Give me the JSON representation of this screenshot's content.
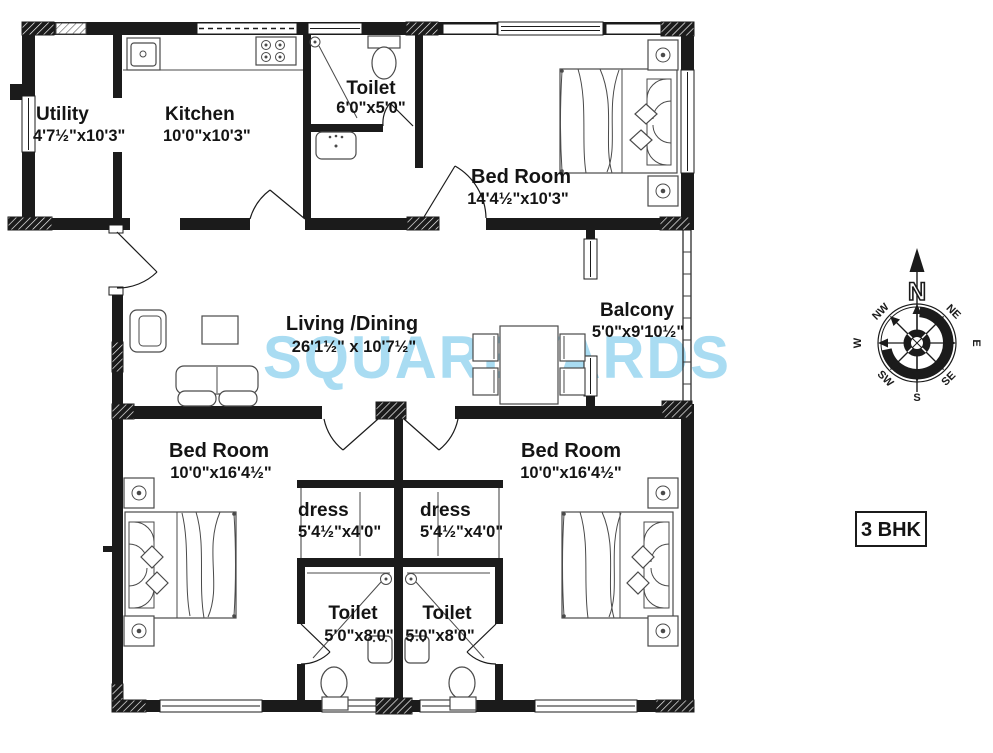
{
  "watermark": "SQUAREYARDS",
  "unit_label": "3 BHK",
  "rooms": {
    "utility": {
      "name": "Utility",
      "dims": "4'7½\"x10'3\""
    },
    "kitchen": {
      "name": "Kitchen",
      "dims": "10'0\"x10'3\""
    },
    "toilet_top": {
      "name": "Toilet",
      "dims": "6'0\"x5'0\""
    },
    "bedroom_top": {
      "name": "Bed Room",
      "dims": "14'4½\"x10'3\""
    },
    "living_dining": {
      "name": "Living /Dining",
      "dims": "26'1½\" x 10'7½\""
    },
    "balcony": {
      "name": "Balcony",
      "dims": "5'0\"x9'10½\""
    },
    "bedroom_left": {
      "name": "Bed Room",
      "dims": "10'0\"x16'4½\""
    },
    "dress_left": {
      "name": "dress",
      "dims": "5'4½\"x4'0\""
    },
    "toilet_left": {
      "name": "Toilet",
      "dims": "5'0\"x8'0\""
    },
    "dress_right": {
      "name": "dress",
      "dims": "5'4½\"x4'0\""
    },
    "toilet_right": {
      "name": "Toilet",
      "dims": "5'0\"x8'0\""
    },
    "bedroom_right": {
      "name": "Bed Room",
      "dims": "10'0\"x16'4½\""
    }
  },
  "compass": {
    "n": "N",
    "ne": "NE",
    "e": "E",
    "se": "SE",
    "s": "S",
    "sw": "SW",
    "w": "W",
    "nw": "NW"
  },
  "colors": {
    "ink": "#1b1b1b",
    "watermark_blue": "#9bd7f0"
  }
}
